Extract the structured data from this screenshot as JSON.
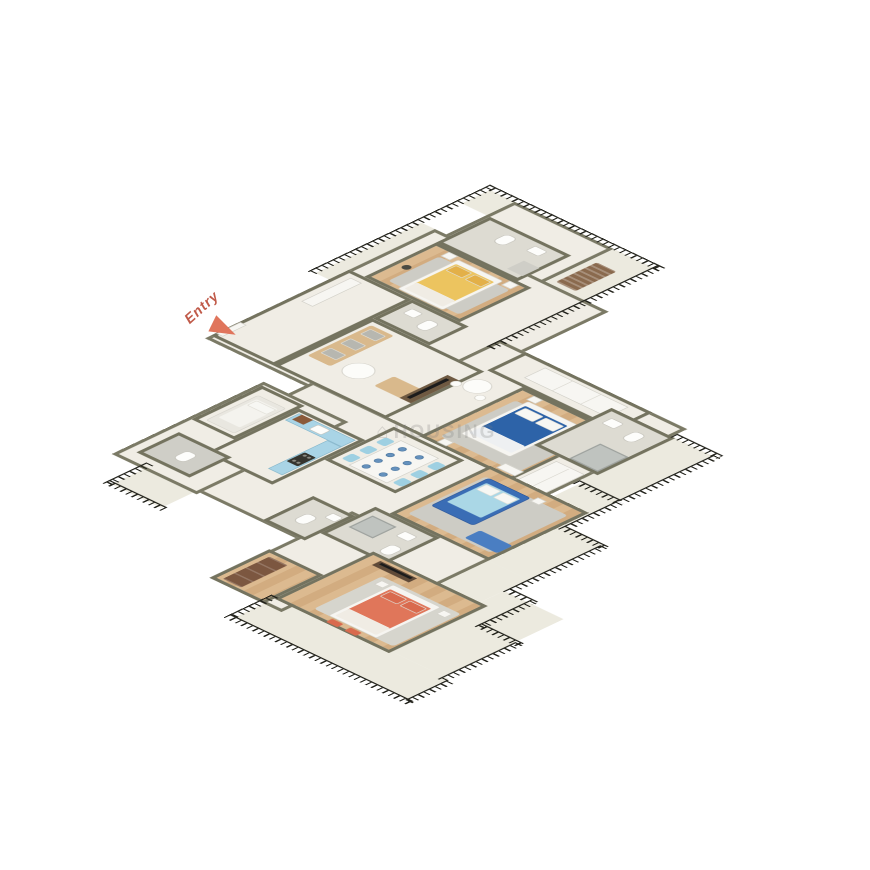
{
  "scene": {
    "type": "3d-isometric-floor-plan-render",
    "description": "Top-down 3D render of a multi-bedroom apartment with balconies and black iron railings",
    "entry": {
      "label": "Entry"
    },
    "watermark": {
      "logo_glyph": "⌂",
      "text": "HOUSING"
    },
    "colors": {
      "wall_top": "#74735f",
      "exterior_wall": "#7b7a66",
      "floor_cream": "#f0ede5",
      "floor_balcony": "#eceadf",
      "floor_wood": "#dcba90",
      "floor_tile": "#dddbd2",
      "railing_iron": "#23231c",
      "bed_yellow": "#ecc45f",
      "pillow_yellow": "#e3b048",
      "bed_master_blue": "#2d63a8",
      "bed_kids_frame_blue": "#3a6db5",
      "bed_kids_linen": "#aad7e6",
      "bed_orange": "#e0765a",
      "pillow_orange": "#d96a4e",
      "sofa_tan": "#d9b98c",
      "sofa_pillow_gray": "#b7b7b0",
      "dining_chair_blue": "#9ed0e2",
      "kitchen_cabinet_blue": "#a9d4e6",
      "kitchen_vent_brown": "#8a5a3a",
      "wardrobe_brown": "#7c5740",
      "lounger_brown": "#8a6a4e",
      "window_seat_blue": "#4a7ec2",
      "rug_gray": "#cdccc5",
      "entry_text": "#c05a49",
      "entry_arrow": "#e0755c",
      "watermark_gray": "rgba(125,125,125,0.25)"
    },
    "rooms": [
      {
        "id": "bedroom-yellow",
        "floor": "wood",
        "furniture": [
          "double bed with yellow bedding",
          "gray rug",
          "two nightstands",
          "dark vase"
        ]
      },
      {
        "id": "bathroom-top",
        "floor": "tile",
        "furniture": [
          "toilet",
          "washbasin",
          "shower"
        ]
      },
      {
        "id": "balcony-top",
        "floor": "concrete",
        "furniture": [
          "brown lounger"
        ],
        "edge": "black iron railing"
      },
      {
        "id": "powder-toilet",
        "floor": "tile",
        "furniture": [
          "toilet",
          "pedestal basin"
        ]
      },
      {
        "id": "living-room",
        "floor": "cream-marble",
        "furniture": [
          "tan sofa with gray pillows",
          "tan chaise",
          "round white coffee table",
          "TV console with TV"
        ]
      },
      {
        "id": "entry-foyer",
        "floor": "cream-marble",
        "furniture": [
          "entry door"
        ]
      },
      {
        "id": "hallway",
        "floor": "cream-marble",
        "furniture": [
          "round breakfast table with two stools",
          "white wardrobe run"
        ]
      },
      {
        "id": "dining",
        "floor": "cream-marble",
        "furniture": [
          "white dining table with 8 place settings",
          "6 light-blue chairs"
        ]
      },
      {
        "id": "kitchen",
        "floor": "cream-marble",
        "furniture": [
          "light-blue L-counter",
          "sink",
          "4-burner hob",
          "brown vent box"
        ]
      },
      {
        "id": "maid-room",
        "floor": "cream-marble",
        "furniture": [
          "single white bed"
        ]
      },
      {
        "id": "maid-toilet",
        "floor": "tile",
        "furniture": [
          "toilet"
        ]
      },
      {
        "id": "balcony-southwest",
        "floor": "concrete",
        "edge": "black iron railing"
      },
      {
        "id": "master-bedroom",
        "floor": "wood",
        "furniture": [
          "double bed dark-blue",
          "gray rug",
          "nightstands",
          "dresser"
        ]
      },
      {
        "id": "master-bathroom",
        "floor": "tile",
        "furniture": [
          "glass shower",
          "toilet",
          "washbasin"
        ]
      },
      {
        "id": "balcony-east",
        "floor": "concrete",
        "edge": "black iron railing"
      },
      {
        "id": "kids-bedroom",
        "floor": "wood",
        "furniture": [
          "blue-frame bed with light-blue linen",
          "blue window seat",
          "rug"
        ]
      },
      {
        "id": "common-bathroom",
        "floor": "tile",
        "furniture": [
          "shower",
          "washbasin",
          "toilet"
        ]
      },
      {
        "id": "toilet-2",
        "floor": "tile",
        "furniture": [
          "toilet",
          "basin"
        ]
      },
      {
        "id": "dressing-corridor",
        "floor": "wood",
        "furniture": [
          "brown wardrobe"
        ]
      },
      {
        "id": "bedroom-orange",
        "floor": "wood",
        "furniture": [
          "double bed coral-orange",
          "two orange ottomans",
          "TV console",
          "rug",
          "nightstands"
        ]
      },
      {
        "id": "terrace-south",
        "floor": "concrete",
        "edge": "stepped black iron railing"
      }
    ]
  }
}
